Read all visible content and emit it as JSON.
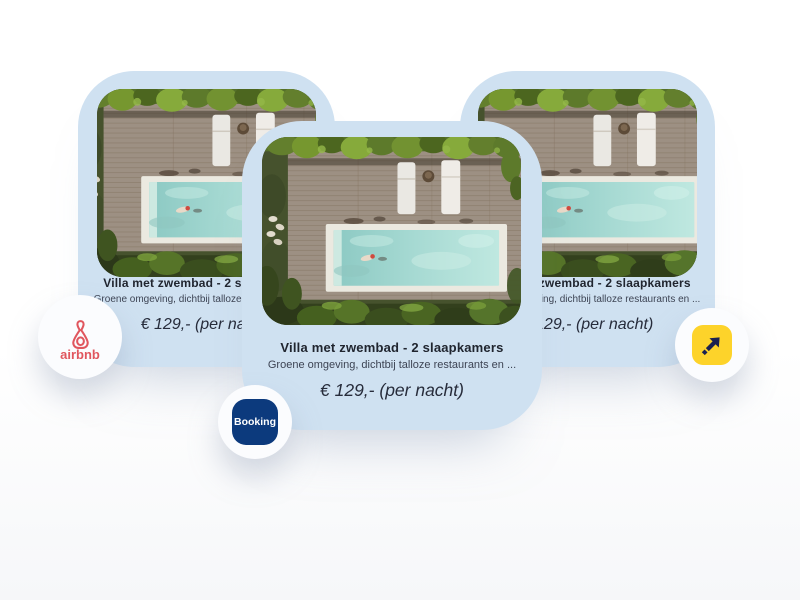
{
  "cards": [
    {
      "position": "left",
      "title": "Villa met zwembad - 2 slaapkamers",
      "description": "Groene omgeving, dichtbij talloze restaurants en ...",
      "price": "€ 129,- (per nacht)"
    },
    {
      "position": "middle",
      "title": "Villa met zwembad - 2 slaapkamers",
      "description": "Groene omgeving, dichtbij talloze restaurants en ...",
      "price": "€ 129,- (per nacht)"
    },
    {
      "position": "right",
      "title": "Villa met zwembad - 2 slaapkamers",
      "description": "Groene omgeving, dichtbij talloze restaurants en ...",
      "price": "€ 129,- (per nacht)"
    }
  ],
  "badges": {
    "airbnb": {
      "label": "airbnb",
      "brand_color": "#e0565e"
    },
    "booking": {
      "label": "Booking",
      "brand_color": "#0c3a7d"
    },
    "expedia": {
      "square_color": "#fdd32a",
      "arrow_color": "#1b2150"
    }
  },
  "colors": {
    "card_background": "#cfe1f1",
    "title_text": "#20252f",
    "description_text": "#3d4454",
    "price_text": "#272c3b",
    "pool_water": "#a7dad3"
  }
}
